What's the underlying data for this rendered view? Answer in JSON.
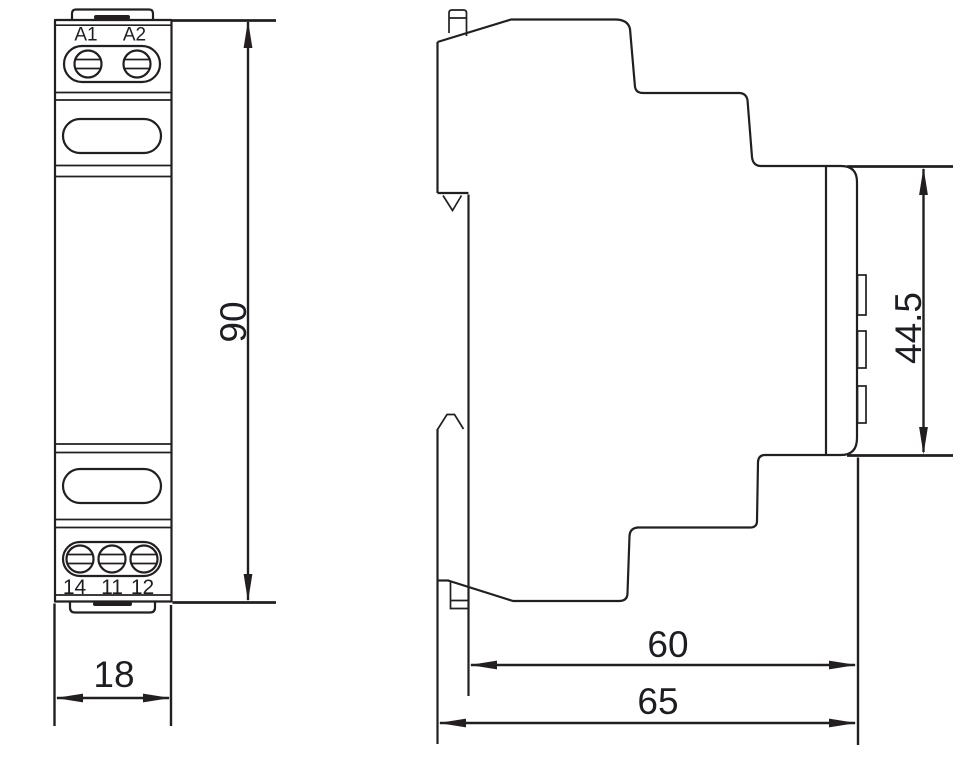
{
  "drawing": {
    "front_view": {
      "terminal_labels_top": [
        "A1",
        "A2"
      ],
      "terminal_labels_bottom": [
        "14",
        "11",
        "12"
      ],
      "dim_height": "90",
      "dim_width": "18"
    },
    "side_view": {
      "dim_front_height": "44.5",
      "dim_depth_body": "60",
      "dim_depth_total": "65"
    },
    "colors": {
      "line": "#231f20",
      "text": "#1d1e24",
      "background": "#ffffff"
    }
  }
}
